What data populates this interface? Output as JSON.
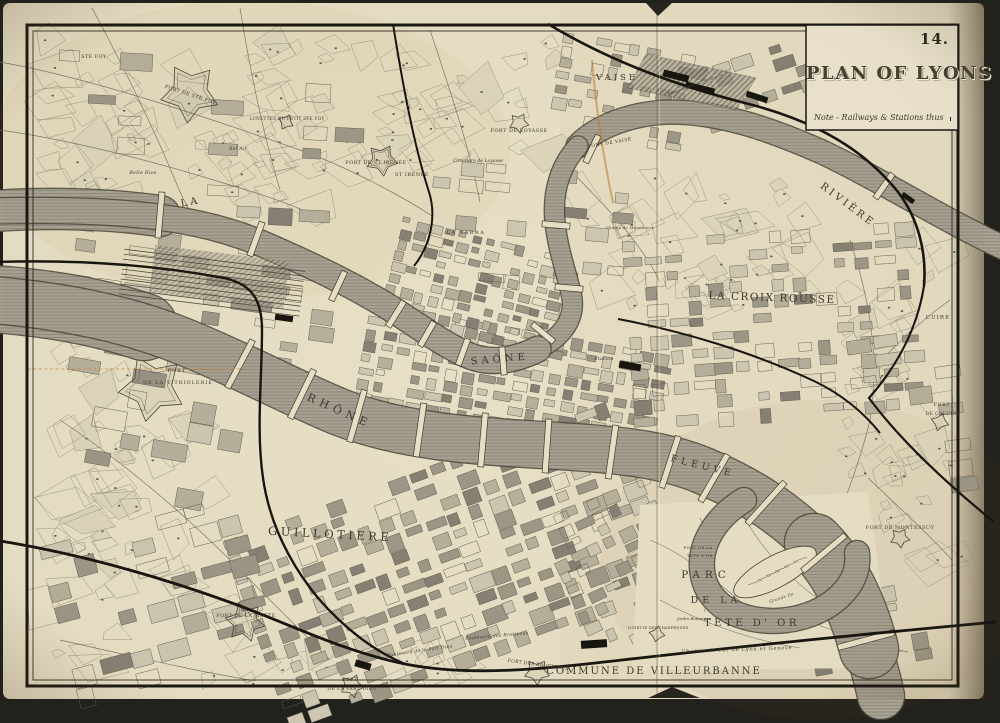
{
  "page": {
    "number": "14.",
    "title": "PLAN OF LYONS",
    "legend_note": "Note - Railways & Stations thus"
  },
  "map": {
    "colors": {
      "paper": "#e8e0c6",
      "paper_light": "#ece4cf",
      "ink": "#3d3930",
      "water": "#a9a395",
      "water_edge": "#4e4b3d",
      "rail": "#17150f",
      "route_highlight": "#c07a30"
    },
    "labels": [
      {
        "id": "riviere",
        "t": "RIVIÈRE",
        "x": 846,
        "y": 207,
        "r": 37,
        "s": 10,
        "sp": 3
      },
      {
        "id": "la",
        "t": "LA",
        "x": 191,
        "y": 205,
        "r": -10,
        "s": 10,
        "sp": 3
      },
      {
        "id": "saone",
        "t": "SAÔNE",
        "x": 500,
        "y": 362,
        "r": -5,
        "s": 10,
        "sp": 4
      },
      {
        "id": "rhone",
        "t": "RHÔNE",
        "x": 338,
        "y": 414,
        "r": 24,
        "s": 11,
        "sp": 5
      },
      {
        "id": "fleuve",
        "t": "FLEUVE",
        "x": 702,
        "y": 469,
        "r": 14,
        "s": 9.5,
        "sp": 4
      },
      {
        "id": "vaise",
        "t": "VAISE",
        "x": 617,
        "y": 80,
        "r": 0,
        "s": 8.5,
        "sp": 3
      },
      {
        "id": "la-croix-rousse",
        "t": "LA CROIX ROUSSE",
        "x": 772,
        "y": 301,
        "r": 2,
        "s": 10.5,
        "sp": 1.5
      },
      {
        "id": "guillotiere",
        "t": "GUILLOTIERE",
        "x": 330,
        "y": 538,
        "r": 3,
        "s": 11.5,
        "sp": 3.5
      },
      {
        "id": "parc-line1",
        "t": "PARC",
        "x": 706,
        "y": 578,
        "r": 0,
        "s": 10.5,
        "sp": 5
      },
      {
        "id": "parc-line2",
        "t": "DE LA",
        "x": 716,
        "y": 603,
        "r": 0,
        "s": 9.5,
        "sp": 4
      },
      {
        "id": "parc-line3",
        "t": "TETE D' OR",
        "x": 752,
        "y": 626,
        "r": 0,
        "s": 10,
        "sp": 3.5
      },
      {
        "id": "commune-villeurbanne",
        "t": "COMMUNE DE VILLEURBANNE",
        "x": 654,
        "y": 674,
        "r": 0,
        "s": 10,
        "sp": 2
      },
      {
        "id": "la-sarra",
        "t": "LA SARRA",
        "x": 466,
        "y": 234,
        "r": 0,
        "s": 5,
        "sp": 1.5
      },
      {
        "id": "fort-st-irenee",
        "t": "FORT DE ST IRÉNÉE",
        "x": 376,
        "y": 164,
        "r": 0,
        "s": 4.8,
        "sp": 0.5
      },
      {
        "id": "st-irenee",
        "t": "ST IRÉNÉE",
        "x": 412,
        "y": 176,
        "r": 0,
        "s": 5,
        "sp": 0.5
      },
      {
        "id": "cimetiere-loyasse",
        "t": "Cimetière de Loyasse",
        "x": 478,
        "y": 162,
        "r": 0,
        "s": 4.6,
        "sp": 0,
        "i": 1
      },
      {
        "id": "fort-loyasse",
        "t": "FORT DE LOYASSE",
        "x": 519,
        "y": 132,
        "r": 0,
        "s": 5,
        "sp": 0.5
      },
      {
        "id": "pont-de-vaise",
        "t": "PONT DE VAISE",
        "x": 610,
        "y": 144,
        "r": -10,
        "s": 4.5,
        "sp": 0.5
      },
      {
        "id": "ste-foy",
        "t": "STE FOY",
        "x": 94,
        "y": 58,
        "r": 0,
        "s": 4.8,
        "sp": 0.5
      },
      {
        "id": "fort-ste-foy",
        "t": "FORT DE STE FOY",
        "x": 190,
        "y": 96,
        "r": 18,
        "s": 4.8,
        "sp": 0.5
      },
      {
        "id": "lunettes-petit-ste-foy",
        "t": "LUNETTES DU PETIT STE FOY",
        "x": 287,
        "y": 120,
        "r": 0,
        "s": 4.2,
        "sp": 0.3
      },
      {
        "id": "belle-rive",
        "t": "Belle Rive",
        "x": 143,
        "y": 174,
        "r": 0,
        "s": 4.8,
        "sp": 0.3,
        "i": 1
      },
      {
        "id": "bel-air",
        "t": "Bel Air",
        "x": 238,
        "y": 150,
        "r": 0,
        "s": 4.5,
        "sp": 0.3,
        "i": 1
      },
      {
        "id": "fort-vitriolerie-line1",
        "t": "FORT",
        "x": 177,
        "y": 372,
        "r": 0,
        "s": 5,
        "sp": 1
      },
      {
        "id": "fort-vitriolerie-line2",
        "t": "DE LA VITRIOLERIE",
        "x": 178,
        "y": 384,
        "r": 0,
        "s": 5,
        "sp": 1
      },
      {
        "id": "fort-la-motte",
        "t": "FORT DE LA MOTTE",
        "x": 246,
        "y": 617,
        "r": 0,
        "s": 4.8,
        "sp": 0.5
      },
      {
        "id": "fort-des-brotteaux",
        "t": "FORT DES BROTTEAUX",
        "x": 538,
        "y": 666,
        "r": 8,
        "s": 4.5,
        "sp": 0.3
      },
      {
        "id": "fort-part-dieu-line1",
        "t": "FORT",
        "x": 350,
        "y": 681,
        "r": 0,
        "s": 4.5,
        "sp": 0.8
      },
      {
        "id": "fort-part-dieu-line2",
        "t": "DE LA PART DIEU",
        "x": 352,
        "y": 690,
        "r": 0,
        "s": 4.5,
        "sp": 0.5
      },
      {
        "id": "blvd-part-dieu",
        "t": "Boulevard de la Part Dieu",
        "x": 420,
        "y": 652,
        "r": -8,
        "s": 4.5,
        "sp": 0.3,
        "i": 1
      },
      {
        "id": "blvd-brotteaux",
        "t": "Boulevard des Brotteaux",
        "x": 497,
        "y": 637,
        "r": -5,
        "s": 4.5,
        "sp": 0.3,
        "i": 1
      },
      {
        "id": "cuire",
        "t": "CUIRE",
        "x": 938,
        "y": 319,
        "r": 0,
        "s": 5.5,
        "sp": 1
      },
      {
        "id": "fort-caluire-line1",
        "t": "FORT",
        "x": 942,
        "y": 406,
        "r": 0,
        "s": 4.5,
        "sp": 0.8
      },
      {
        "id": "fort-caluire-line2",
        "t": "DE CALUIRE",
        "x": 943,
        "y": 415,
        "r": 0,
        "s": 4.5,
        "sp": 0.5
      },
      {
        "id": "fort-montessuy",
        "t": "FORT DE MONTESSUY",
        "x": 900,
        "y": 529,
        "r": 0,
        "s": 5,
        "sp": 0.5
      },
      {
        "id": "station",
        "t": "Station",
        "x": 604,
        "y": 360,
        "r": 0,
        "s": 4.8,
        "sp": 0.3,
        "i": 1
      },
      {
        "id": "chemin-de-fer-lyon-geneve",
        "t": "Chemin de Fer de Lyon et Geneve",
        "x": 737,
        "y": 651,
        "r": -2,
        "s": 5,
        "sp": 0.8
      },
      {
        "id": "grande-ile",
        "t": "Grande Ile",
        "x": 782,
        "y": 599,
        "r": -18,
        "s": 4.2,
        "sp": 0.3,
        "i": 1
      },
      {
        "id": "jardin-botanique",
        "t": "Jardin Botanique",
        "x": 694,
        "y": 620,
        "r": 0,
        "s": 4,
        "sp": 0,
        "i": 1
      },
      {
        "id": "lunette-des-charpennes",
        "t": "LUNETTE DES CHARPENNES",
        "x": 658,
        "y": 629,
        "r": 0,
        "s": 3.6,
        "sp": 0.2
      },
      {
        "id": "fort-tete-dor-line1",
        "t": "FORT DE LA",
        "x": 698,
        "y": 549,
        "r": 0,
        "s": 4,
        "sp": 0.3
      },
      {
        "id": "fort-tete-dor-line2",
        "t": "TETE D'OR",
        "x": 700,
        "y": 557,
        "r": 0,
        "s": 4,
        "sp": 0.3
      },
      {
        "id": "champ-de-manoeuvre",
        "t": "Champ de Manoeuvre",
        "x": 630,
        "y": 229,
        "r": 0,
        "s": 4,
        "sp": 0.2,
        "i": 1
      },
      {
        "id": "embarcadere",
        "t": "Embarcadère du Chemin de Fer",
        "x": 700,
        "y": 84,
        "r": -20,
        "s": 3.8,
        "sp": 0.2,
        "i": 1
      }
    ]
  }
}
